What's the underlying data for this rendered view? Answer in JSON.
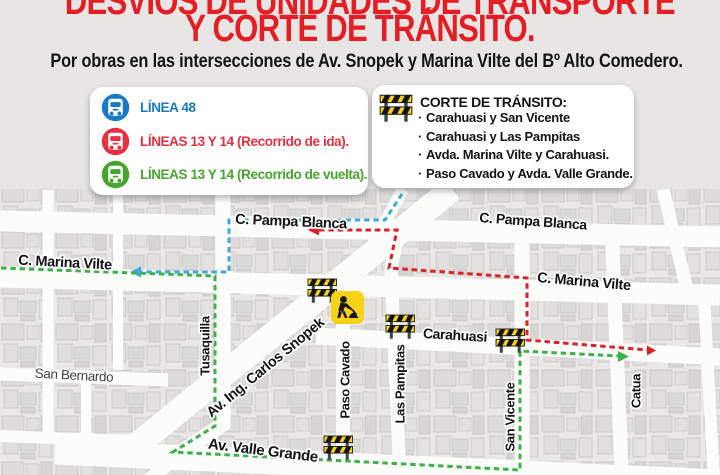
{
  "header": {
    "title_line1": "DESVÍOS DE UNIDADES DE TRANSPORTE",
    "title_line2": "Y CORTE DE TRÁNSITO.",
    "title_color": "#e41e24",
    "subtitle": "Por obras en las intersecciones de Av. Snopek y Marina Vilte del Bº Alto Comedero."
  },
  "legend": {
    "items": [
      {
        "label": "LÍNEA 48",
        "color": "#187ac2",
        "icon": "bus-icon"
      },
      {
        "label": "LÍNEAS 13 Y 14 (Recorrido de ida).",
        "color": "#e53040",
        "icon": "bus-icon"
      },
      {
        "label": "LÍNEAS 13 Y 14 (Recorrido de vuelta).",
        "color": "#46a52c",
        "icon": "bus-icon"
      }
    ]
  },
  "closures": {
    "icon": "road-barrier-icon",
    "title": "CORTE DE TRÁNSITO:",
    "bullet": "·",
    "items": [
      "Carahuasi y San Vicente",
      "Carahuasi y Las Pampitas",
      "Avda. Marina Vilte y Carahuasi.",
      "Paso Cavado y Avda. Valle Grande."
    ]
  },
  "map": {
    "street_labels": [
      {
        "text": "C. Pampa Blanca"
      },
      {
        "text": "C. Pampa Blanca"
      },
      {
        "text": "C. Marina Vilte"
      },
      {
        "text": "C. Marina Vilte"
      },
      {
        "text": "Carahuasi"
      },
      {
        "text": "Tusaquilla"
      },
      {
        "text": "Av. Ing. Carlos Snopek"
      },
      {
        "text": "Paso Cavado"
      },
      {
        "text": "Las Pampitas"
      },
      {
        "text": "San Vicente"
      },
      {
        "text": "Catua"
      },
      {
        "text": "Av. Valle Grande"
      }
    ],
    "area_label": "San Bernardo",
    "routes": {
      "linea48": {
        "color": "#3fa8dd",
        "end": "arrow-left"
      },
      "lineas1314_ida": {
        "color": "#dc2127",
        "start": "arrow-left",
        "end": "arrow-right"
      },
      "lineas1314_vuelta": {
        "color": "#3db24a",
        "end": "arrow-right"
      }
    },
    "markers": {
      "barrier_color": "#f6d01e",
      "barrier_count": 4,
      "roadworks_color": "#f8d216"
    }
  }
}
